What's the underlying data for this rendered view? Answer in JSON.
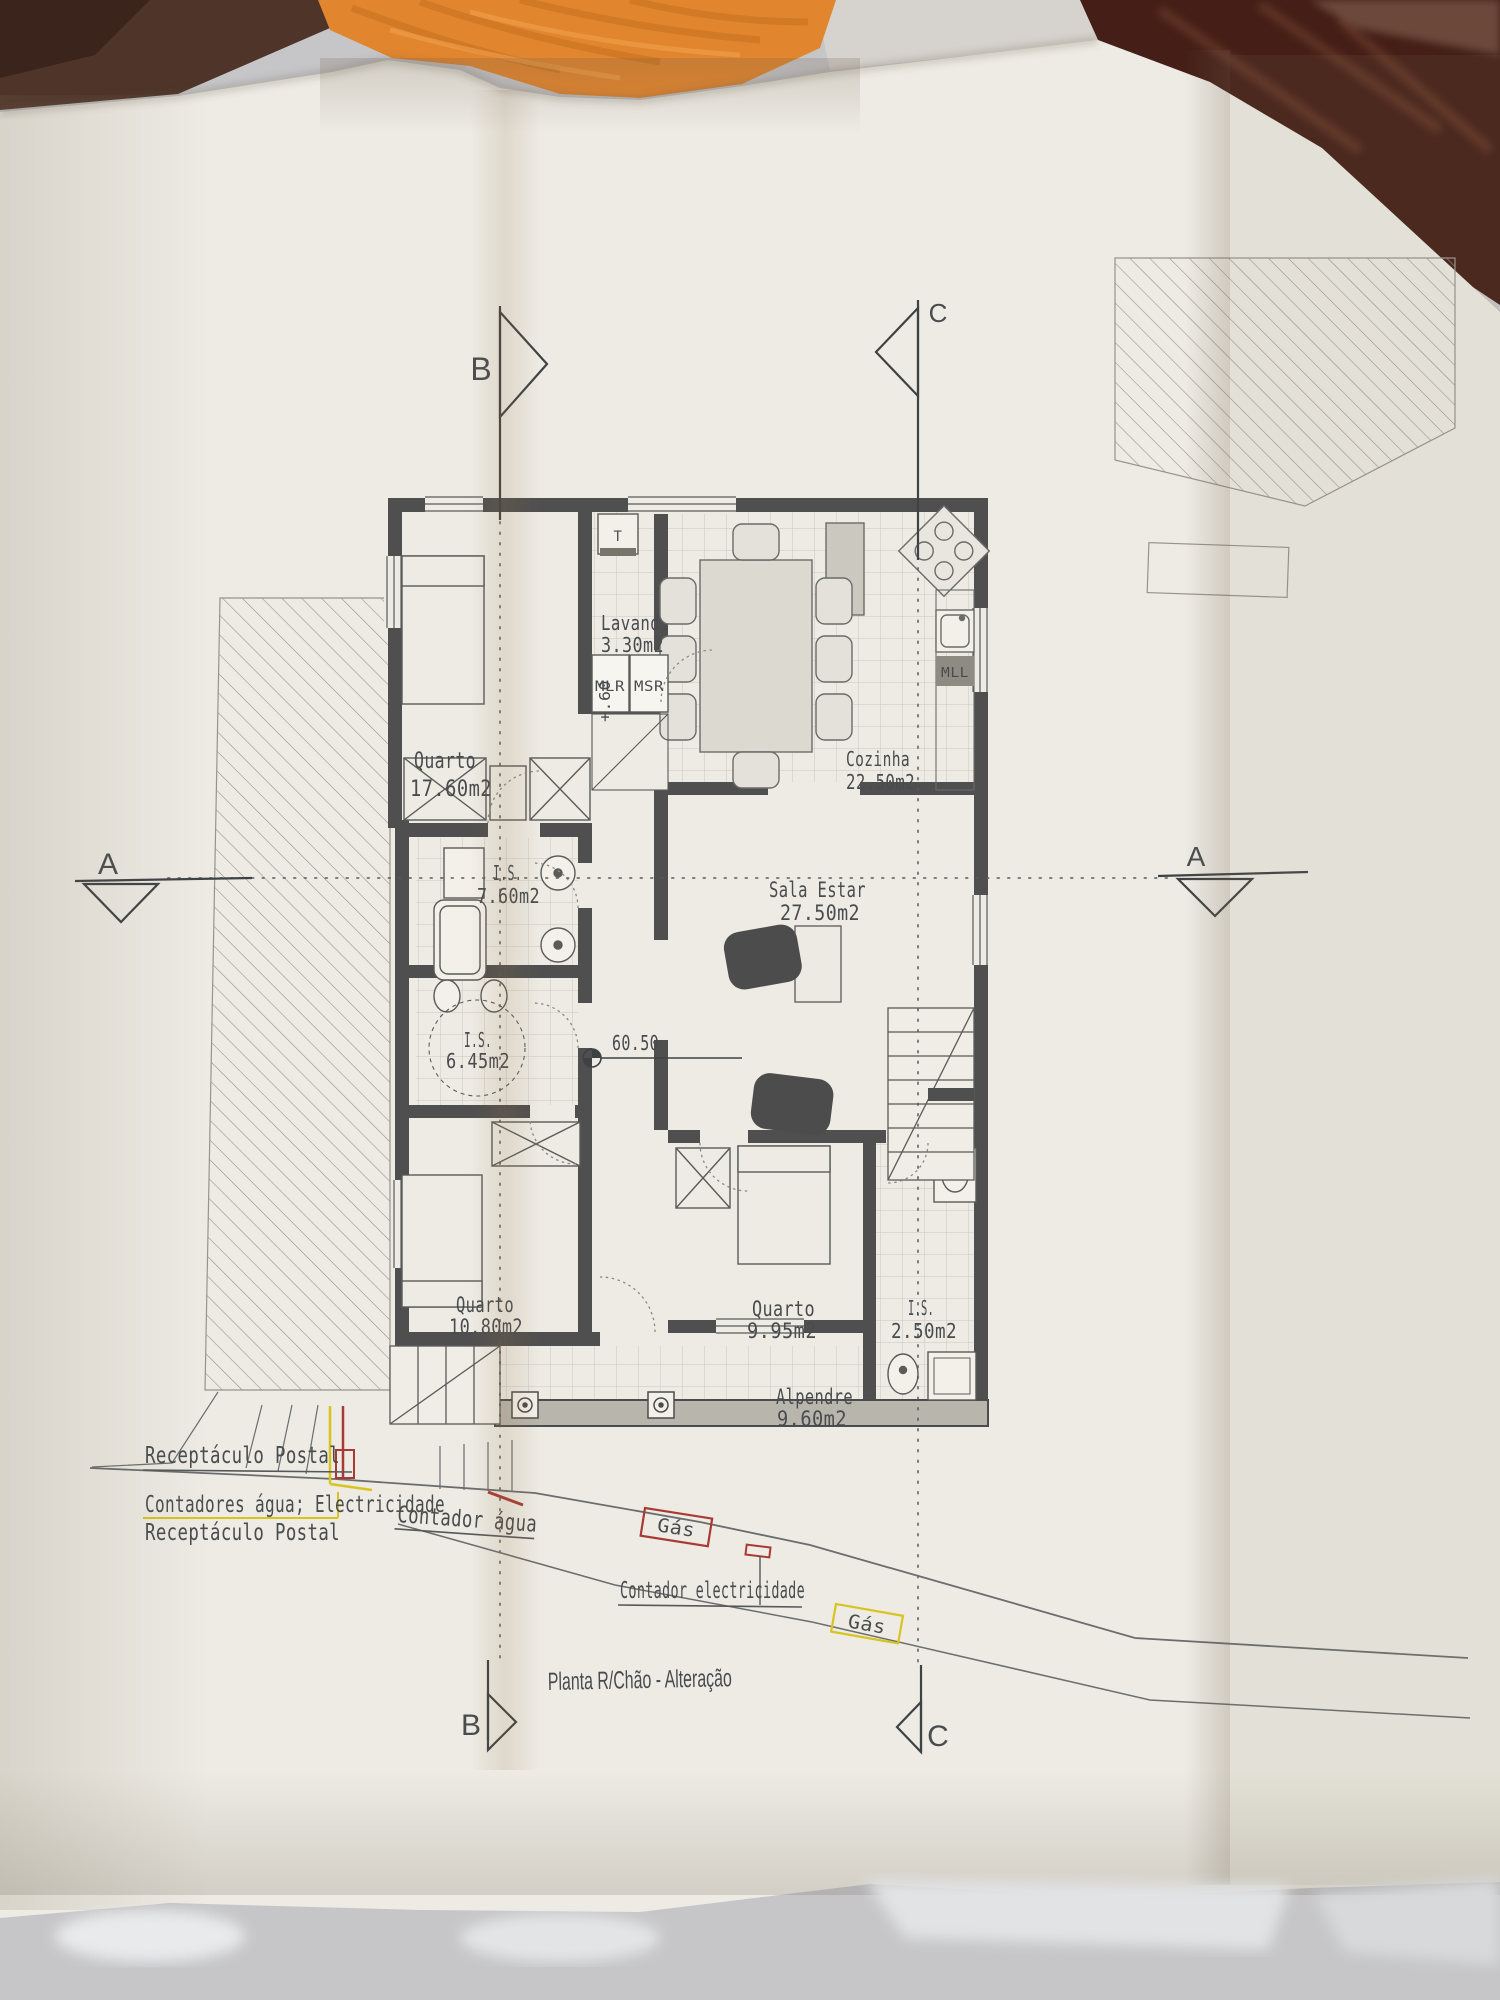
{
  "plan": {
    "title": "Planta R/Chão - Alteração",
    "markers": {
      "section_b_top": "B",
      "section_c_top": "C",
      "section_a_left": "A",
      "section_a_right": "A",
      "section_b_bottom": "B",
      "section_c_bottom": "C",
      "level": "60.50",
      "step_height": "+.60"
    },
    "rooms": [
      {
        "name": "Quarto",
        "area": "17.60m2"
      },
      {
        "name": "Lavand.",
        "area": "3.30m2"
      },
      {
        "name": "Cozinha",
        "area": "22.50m2"
      },
      {
        "name": "I.S.",
        "area": "7.60m2"
      },
      {
        "name": "Sala Estar",
        "area": "27.50m2"
      },
      {
        "name": "I.S.",
        "area": "6.45m2"
      },
      {
        "name": "Quarto",
        "area": "10.80m2"
      },
      {
        "name": "Quarto",
        "area": "9.95m2"
      },
      {
        "name": "I.S.",
        "area": "2.50m2"
      },
      {
        "name": "Alpendre",
        "area": "9.60m2"
      }
    ],
    "appliances": {
      "t": "T",
      "mlr": "MLR",
      "msr": "MSR",
      "mll": "MLL"
    },
    "annotations": {
      "receptaculo_postal": "Receptáculo Postal",
      "contadores": "Contadores água; Electricidade",
      "receptaculo_postal_2": "Receptáculo Postal",
      "contador_agua": "Contador água",
      "gas_1": "Gás",
      "contador_electricidade": "Contador electricidade",
      "gas_2": "Gás"
    },
    "colors": {
      "ink": "#4a4d4f",
      "wall": "#4f4f4f",
      "annotation_yellow": "#d8c31f",
      "annotation_red": "#a93a33",
      "paper": "#edebe4",
      "towel_orange": "#e1852e",
      "table_brown": "#4e3429",
      "maroon": "#451f17",
      "floor_gray": "#c6c6c9"
    }
  }
}
